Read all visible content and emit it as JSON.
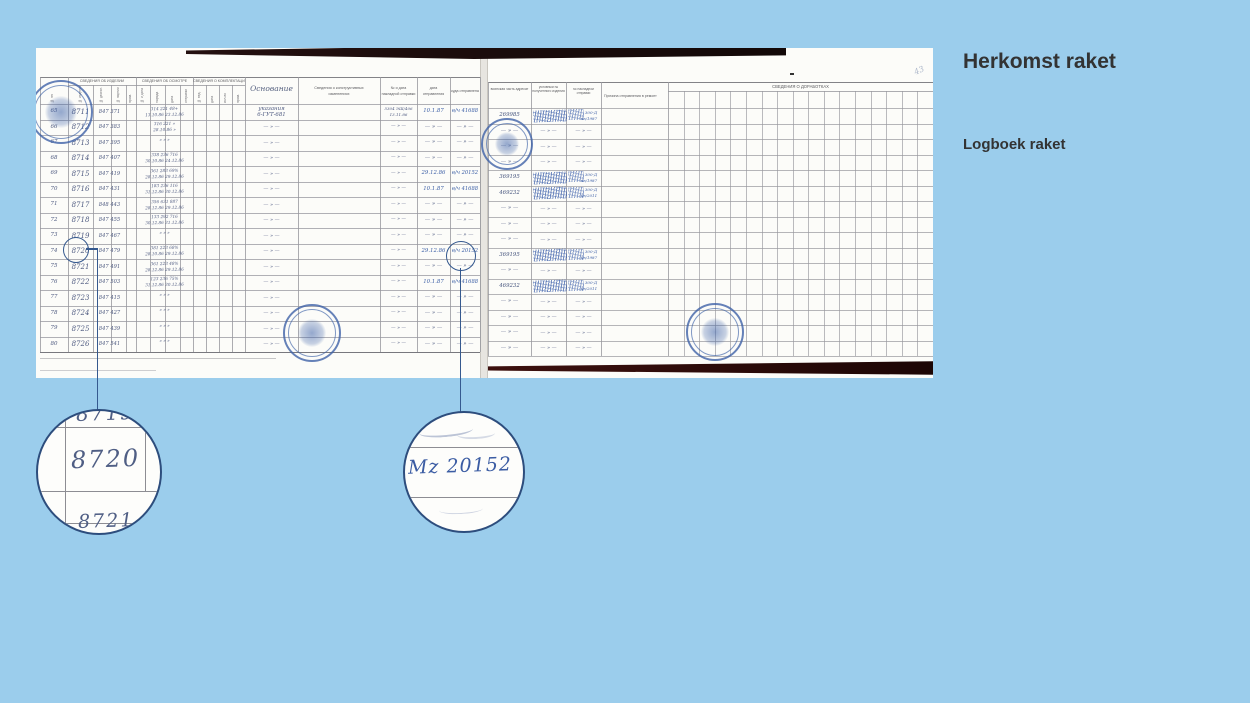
{
  "colors": {
    "background": "#9BCDEC",
    "page_white": "#fcfcf9",
    "table_line": "#97979d",
    "handwriting_ink": "#4e5a80",
    "blue_ink": "#3c5fa6",
    "stamp_blue": "#3e62a8",
    "callout_blue": "#35598f",
    "title_text": "#333333",
    "scan_edge_dark": "#1d0f0d",
    "scan_edge_maroon": "#330d0a"
  },
  "slide": {
    "title": "Herkomst raket",
    "subtitle": "Logboek raket"
  },
  "callouts": {
    "serial_above": "8719",
    "serial_highlight": "8720",
    "serial_below": "8721",
    "unit_highlight": "Mz 20152"
  },
  "document": {
    "left_page": {
      "group_headers": [
        "СВЕДЕНИЯ ОБ ИЗДЕЛИИ",
        "СВЕДЕНИЯ ОБ ОСМОТРЕ",
        "СВЕДЕНИЯ О КОМПЛЕКТАЦИИ"
      ],
      "narrow_headers": [
        "№ изделия",
        "№ двигат.",
        "№ партии",
        "прим.",
        "№ и дата",
        "наряда",
        "дата",
        "отправки",
        "№ вед.",
        "дата",
        "кол-во",
        "прим."
      ],
      "num_header": "№ пп",
      "wide_headers": {
        "osn": "Основание",
        "constr_1": "Сведения о конструктивных",
        "constr_2": "изменениях",
        "nar_1": "№ и дата",
        "nar_2": "накладной отправки",
        "date_1": "дата",
        "date_2": "отправления",
        "dest": "куда отправлена"
      },
      "rows": [
        {
          "n": "65",
          "s": "8711",
          "f": "847 371",
          "m1": "314 221 48+",
          "m2": "13.10.86 23.12.86",
          "o": "указания 6-ГУТ-681",
          "w": "5304 ЭШ/4062 13.11.86",
          "d": "10.1.87",
          "u": "в/ч 41688"
        },
        {
          "n": "66",
          "s": "8712",
          "f": "847 383",
          "m1": "316 221 »",
          "m2": "28.10.86 »",
          "o": "— » —",
          "w": "— » —",
          "d": "— » —",
          "u": "— » —"
        },
        {
          "n": "67",
          "s": "8713",
          "f": "847 395",
          "m1": "»  »  »",
          "m2": "",
          "o": "— » —",
          "w": "— » —",
          "d": "— » —",
          "u": "— » —"
        },
        {
          "n": "68",
          "s": "8714",
          "f": "847 407",
          "m1": "338 236 716",
          "m2": "30.10.86 24.12.86",
          "o": "— » —",
          "w": "— » —",
          "d": "— » —",
          "u": "— » —"
        },
        {
          "n": "69",
          "s": "8715",
          "f": "847 419",
          "m1": "361 283 69%",
          "m2": "28.12.86 29.12.86",
          "o": "— » —",
          "w": "— » —",
          "d": "29.12.86",
          "u": "в/ч 20152"
        },
        {
          "n": "70",
          "s": "8716",
          "f": "847 431",
          "m1": "183 236 116",
          "m2": "31.12.86 30.12.86",
          "o": "— » —",
          "w": "— » —",
          "d": "10.1.87",
          "u": "в/ч 41688"
        },
        {
          "n": "71",
          "s": "8717",
          "f": "848 443",
          "m1": "356 631 887",
          "m2": "28.12.86 29.12.86",
          "o": "— » —",
          "w": "— » —",
          "d": "— » —",
          "u": "— » —"
        },
        {
          "n": "72",
          "s": "8718",
          "f": "847 455",
          "m1": "133 292 716",
          "m2": "30.12.86 31.12.86",
          "o": "— » —",
          "w": "— » —",
          "d": "— » —",
          "u": "— » —"
        },
        {
          "n": "73",
          "s": "8719",
          "f": "847 467",
          "m1": "»  »  »",
          "m2": "",
          "o": "— » —",
          "w": "— » —",
          "d": "— » —",
          "u": "— » —"
        },
        {
          "n": "74",
          "s": "8720",
          "f": "847 479",
          "m1": "381 223 68%",
          "m2": "28.10.86 29.12.86",
          "o": "— » —",
          "w": "— » —",
          "d": "29.12.86",
          "u": "в/ч 20152"
        },
        {
          "n": "75",
          "s": "8721",
          "f": "847 491",
          "m1": "361 223 48%",
          "m2": "28.12.86 29.12.86",
          "o": "— » —",
          "w": "— » —",
          "d": "— » —",
          "u": "— » —"
        },
        {
          "n": "76",
          "s": "8722",
          "f": "847 503",
          "m1": "123 236 75%",
          "m2": "31.12.86 30.12.86",
          "o": "— » —",
          "w": "— » —",
          "d": "10.1.87",
          "u": "в/ч 41688"
        },
        {
          "n": "77",
          "s": "8723",
          "f": "847 415",
          "m1": "»  »  »",
          "m2": "",
          "o": "— » —",
          "w": "— » —",
          "d": "— » —",
          "u": "— » —"
        },
        {
          "n": "78",
          "s": "8724",
          "f": "847 427",
          "m1": "»  »  »",
          "m2": "",
          "o": "— » —",
          "w": "— » —",
          "d": "— » —",
          "u": "— » —"
        },
        {
          "n": "79",
          "s": "8725",
          "f": "847 439",
          "m1": "»  »  »",
          "m2": "",
          "o": "— » —",
          "w": "— » —",
          "d": "— » —",
          "u": "— » —"
        },
        {
          "n": "80",
          "s": "8726",
          "f": "847 541",
          "m1": "»  »  »",
          "m2": "",
          "o": "— » —",
          "w": "— » —",
          "d": "— » —",
          "u": "— » —"
        }
      ]
    },
    "right_page": {
      "col_headers": [
        "воинская часть адресат",
        "условный № полученного изделия",
        "№ накладной отправки",
        "Причина отправления в ремонт"
      ],
      "group_header": "СВЕДЕНИЯ О ДОРАБОТКАХ",
      "corner_mark": "43",
      "rows": [
        {
          "a": "269985",
          "stamp": true,
          "c": "300-Д кв/1987"
        },
        {
          "a": "— » —",
          "stamp": false,
          "c": "— » —"
        },
        {
          "a": "— » —",
          "stamp": false,
          "c": "— » —"
        },
        {
          "a": "— » —",
          "stamp": false,
          "c": "— » —"
        },
        {
          "a": "369195",
          "stamp": true,
          "c": "300-Д кв/1987"
        },
        {
          "a": "469232",
          "stamp": true,
          "c": "300-Д кв/2011"
        },
        {
          "a": "— » —",
          "stamp": false,
          "c": "— » —"
        },
        {
          "a": "— » —",
          "stamp": false,
          "c": "— » —"
        },
        {
          "a": "— » —",
          "stamp": false,
          "c": "— » —"
        },
        {
          "a": "369195",
          "stamp": true,
          "c": "300-Д кв/1987"
        },
        {
          "a": "— » —",
          "stamp": false,
          "c": "— » —"
        },
        {
          "a": "469232",
          "stamp": true,
          "c": "300-Д кв/2011"
        },
        {
          "a": "— » —",
          "stamp": false,
          "c": "— » —"
        },
        {
          "a": "— » —",
          "stamp": false,
          "c": "— » —"
        },
        {
          "a": "— » —",
          "stamp": false,
          "c": "— » —"
        },
        {
          "a": "— » —",
          "stamp": false,
          "c": "— » —"
        }
      ]
    }
  }
}
